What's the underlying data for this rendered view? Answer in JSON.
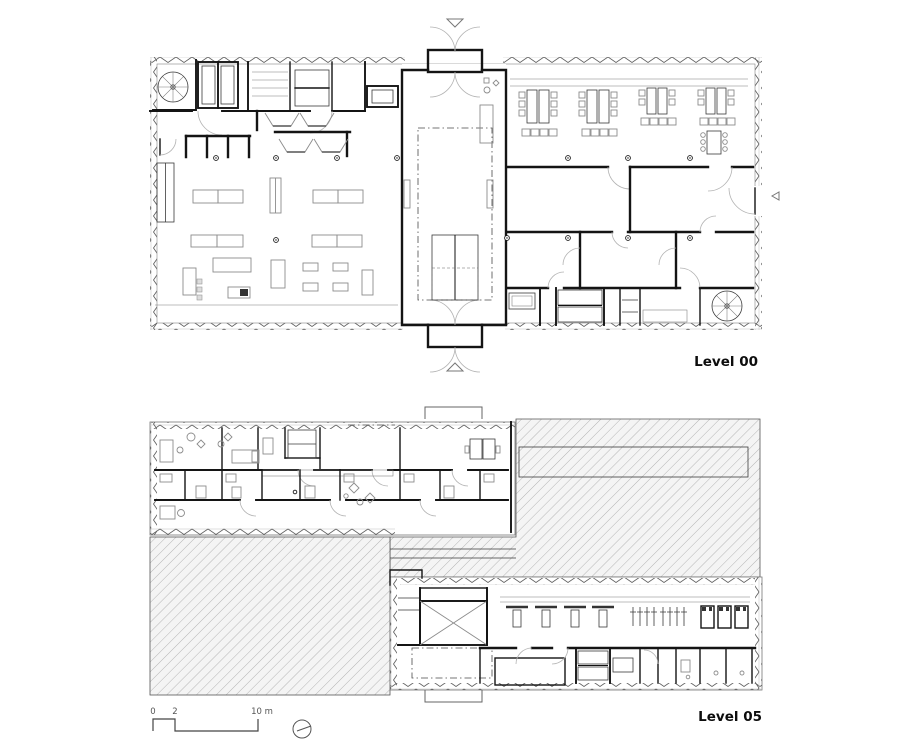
{
  "plans": [
    {
      "label": "Level 00"
    },
    {
      "label": "Level 05"
    }
  ],
  "scale_bar": {
    "ticks": [
      "0",
      "2",
      "10 m"
    ]
  },
  "symbols": {
    "north_indicator": "north-circle-icon",
    "entry_marker_top": "triangle-down",
    "entry_marker_bottom": "triangle-up",
    "side_entry_marker": "triangle-left"
  },
  "colors": {
    "background": "#ffffff",
    "wall": "#141414",
    "thin_line": "#3a3a3a",
    "furniture": "#8c8c8c",
    "roof_hatch": "#b5b5b5",
    "label_text": "#0d0d0d"
  }
}
